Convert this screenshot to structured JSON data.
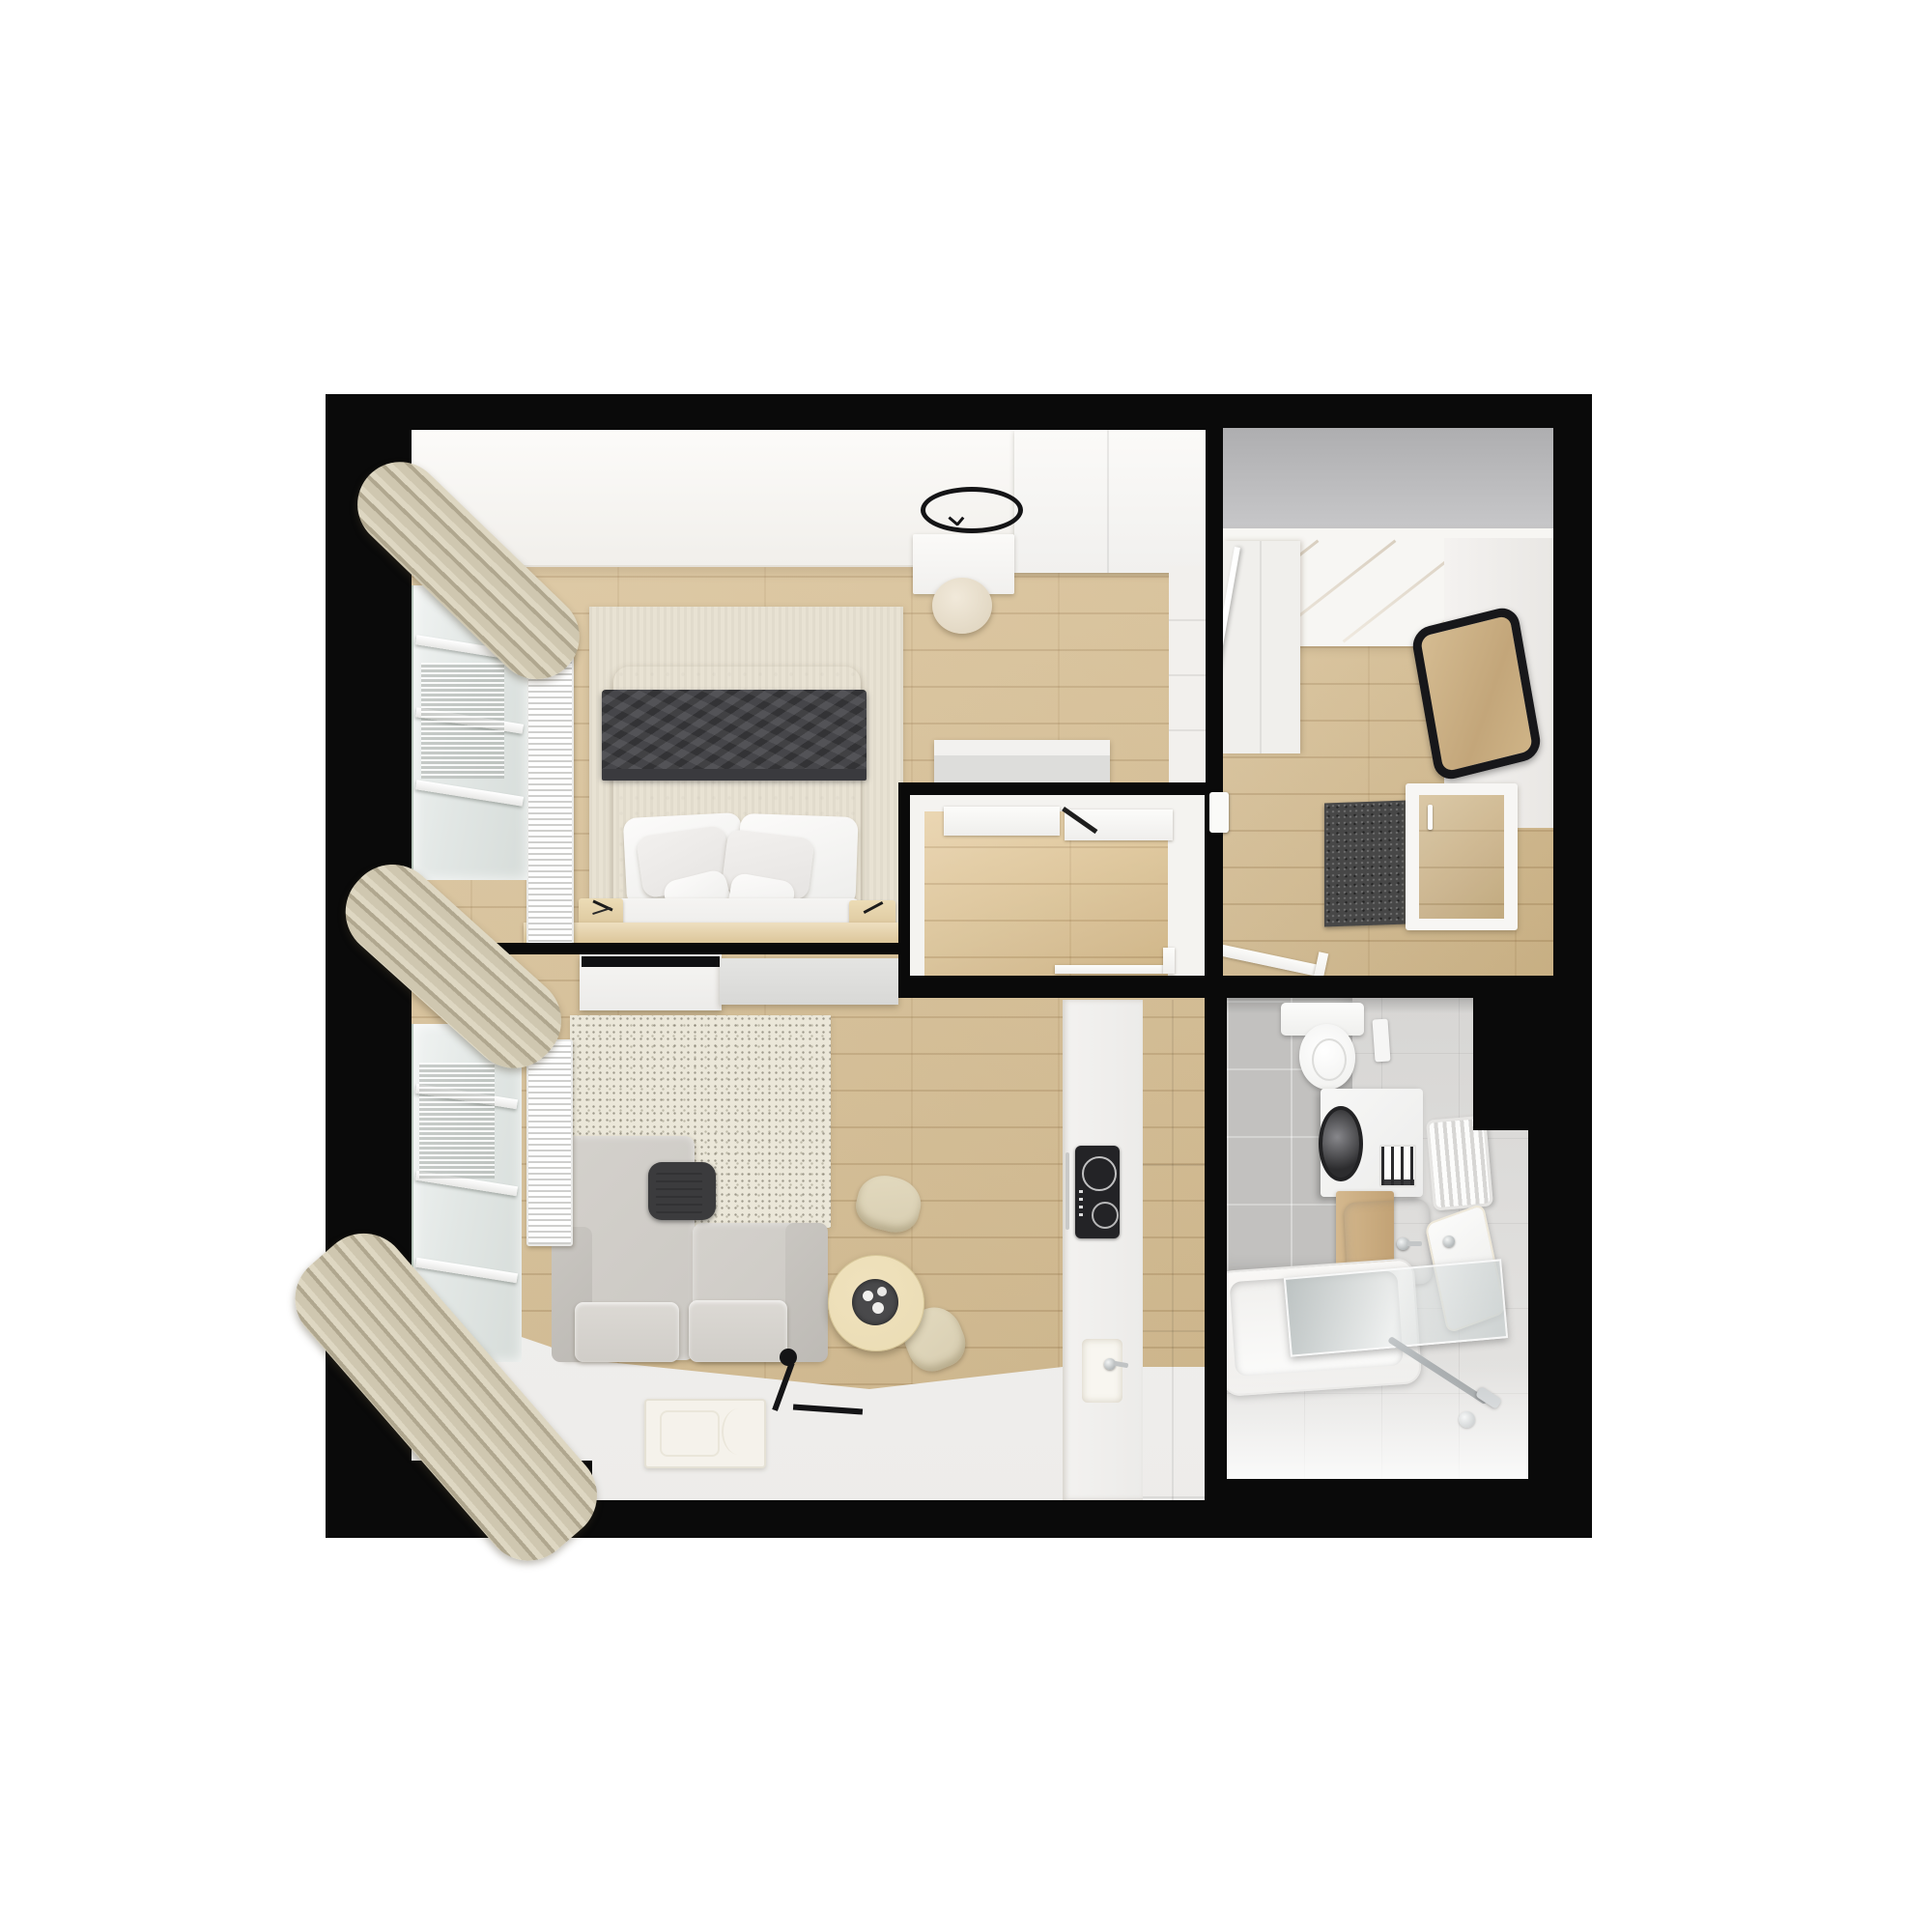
{
  "scene": {
    "type": "3d-floor-plan-top-down-render",
    "subject": "small apartment interior",
    "background": "#ffffff"
  },
  "palette": {
    "bg": "#ffffff",
    "wall": "#0a0a0a",
    "wood1": "#dcc59c",
    "wood2": "#d2b88a",
    "ceiling": "#f7f5f1",
    "grayBand1": "#aeaeb0",
    "grayBand2": "#c7c7c9",
    "sofa": "#cbc8c3",
    "chair": "#d8ceb2",
    "table": "#eadcb4",
    "blanket": "#46464a",
    "rugBeige": "#e8e2d3",
    "rugSpeckle": "#ebe7d9",
    "rugDark": "#474747",
    "curtain": "#cfc7b0",
    "curtainDark": "#b0a78f",
    "bathFloor": "#dddcda",
    "bathTile": "#c2c1bf",
    "counterWhite": "#f0efed",
    "counterGray": "#d4d4d4",
    "cooktop": "#232326",
    "lampBlack": "#141416"
  },
  "rooms": [
    {
      "name": "bedroom",
      "position": "top-left",
      "furniture": [
        "double-bed",
        "dark-gray-blanket",
        "pillows",
        "bedside-table-left",
        "bedside-table-right",
        "foot-bench",
        "area-rug",
        "radiator",
        "window",
        "curtains",
        "wardrobe",
        "desk",
        "pouf",
        "ring-ceiling-lamp",
        "dresser"
      ]
    },
    {
      "name": "entry-hall",
      "position": "top-right",
      "furniture": [
        "gray-ceiling-band",
        "panelled-ceiling",
        "wardrobe",
        "wall-mirror",
        "dark-doormat",
        "entrance-door"
      ]
    },
    {
      "name": "corridor",
      "position": "center",
      "furniture": [
        "door-frames",
        "wood-floor"
      ]
    },
    {
      "name": "living-room",
      "position": "bottom-left",
      "furniture": [
        "sofa",
        "magazine-pocket",
        "speckled-rug",
        "round-dining-table",
        "serving-tray",
        "dining-chair-top",
        "dining-chair-right",
        "floor-lamp",
        "sideboard",
        "white-mat",
        "radiator",
        "window",
        "curtains"
      ]
    },
    {
      "name": "kitchen",
      "position": "bottom-center",
      "furniture": [
        "counter-run",
        "tall-gray-cabinets",
        "induction-cooktop",
        "kitchen-sink",
        "faucet"
      ]
    },
    {
      "name": "bathroom",
      "position": "bottom-right",
      "furniture": [
        "toilet",
        "flush-plate",
        "washing-machine",
        "shelf-grill",
        "towel-radiator",
        "wood-vanity",
        "washbasin",
        "second-basin",
        "bathtub",
        "glass-screen",
        "shower-bar"
      ]
    }
  ]
}
